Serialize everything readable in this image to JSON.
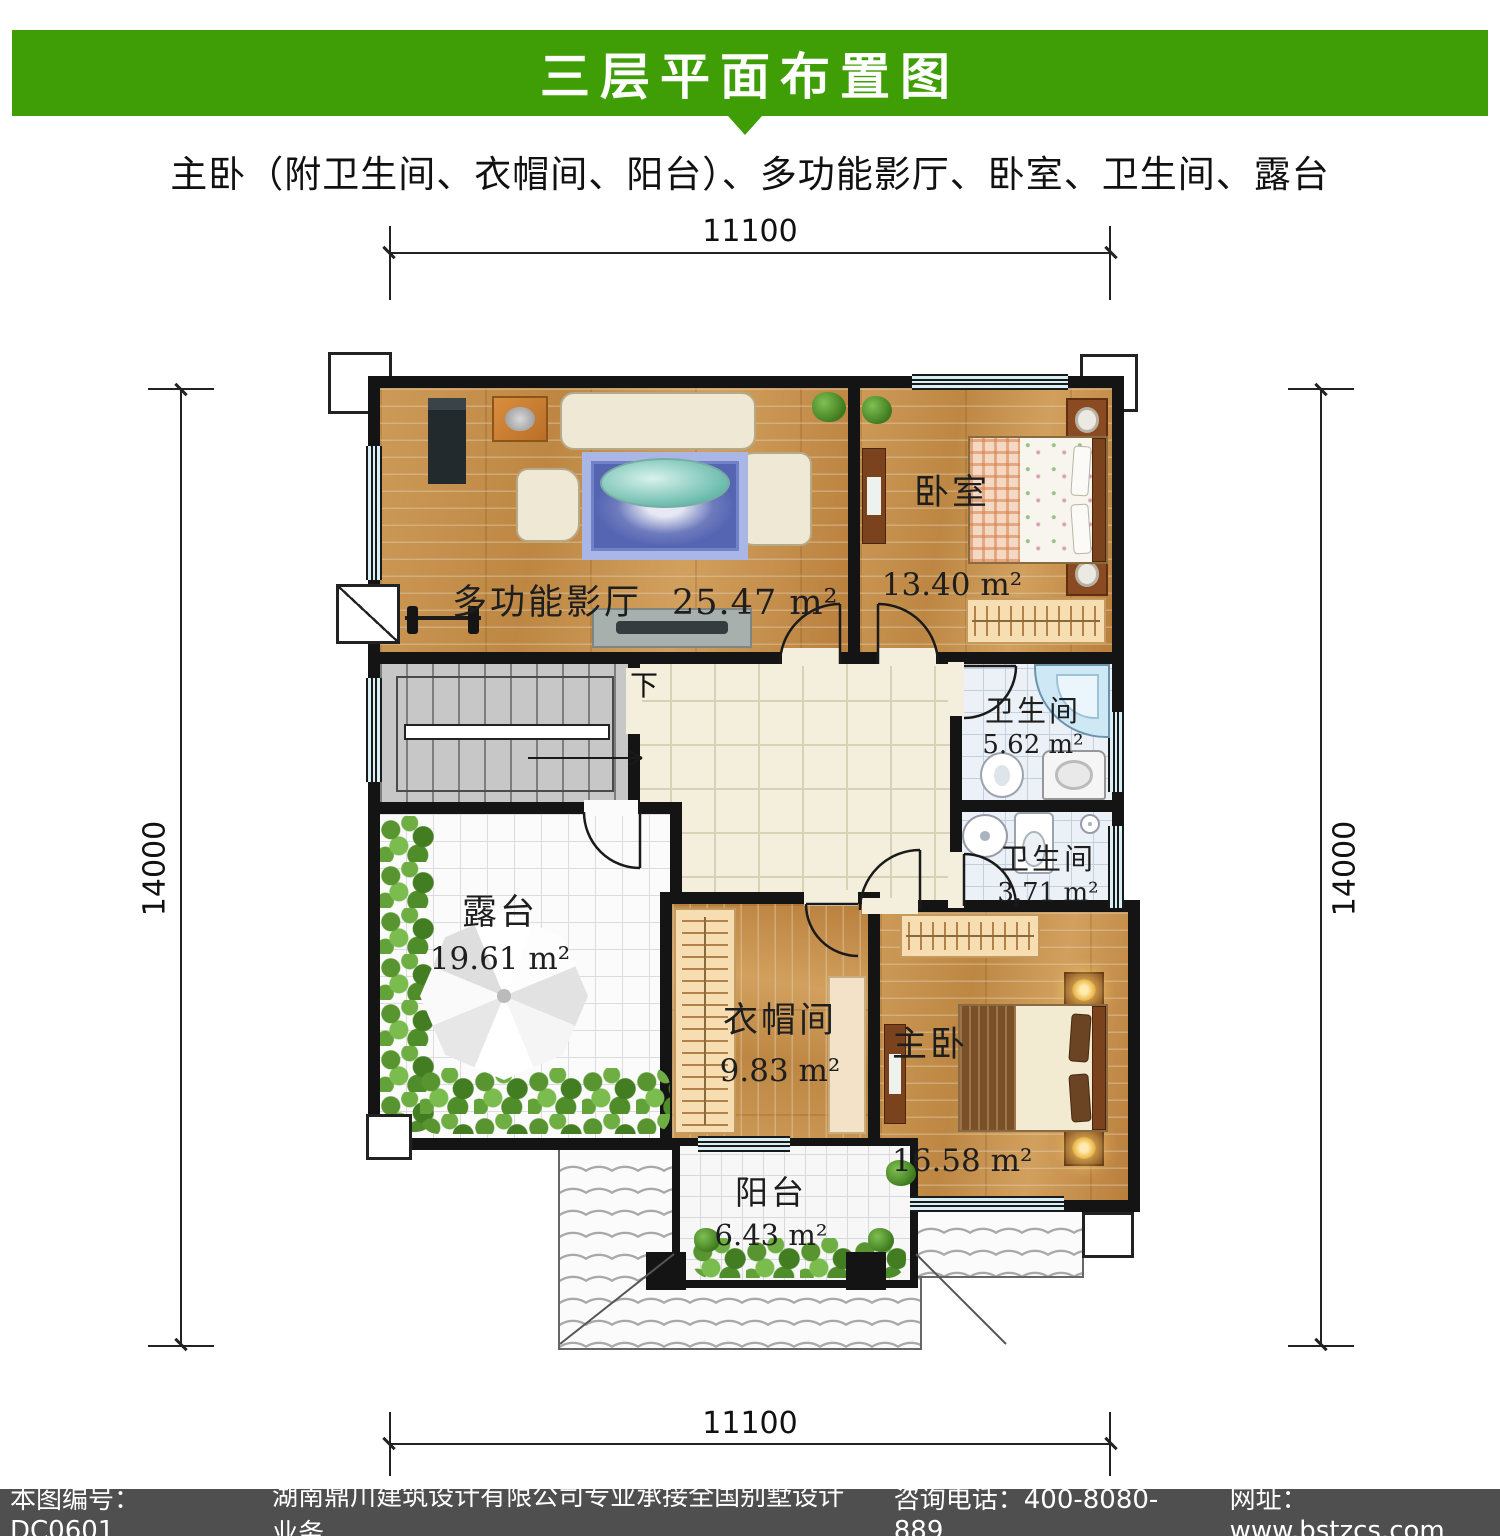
{
  "header": {
    "title": "三层平面布置图",
    "bg_color": "#3f9e06"
  },
  "subtitle": "主卧（附卫生间、衣帽间、阳台）、多功能影厅、卧室、卫生间、露台",
  "dimensions": {
    "top": "11100",
    "bottom": "11100",
    "left": "14000",
    "right": "14000"
  },
  "plan": {
    "stairs_down_label": "下"
  },
  "rooms": [
    {
      "id": "theater",
      "name": "多功能影厅",
      "area": "25.47 m²"
    },
    {
      "id": "bedroom",
      "name": "卧室",
      "area": "13.40 m²"
    },
    {
      "id": "bath1",
      "name": "卫生间",
      "area": "5.62 m²"
    },
    {
      "id": "bath2",
      "name": "卫生间",
      "area": "3.71 m²"
    },
    {
      "id": "terrace",
      "name": "露台",
      "area": "19.61 m²"
    },
    {
      "id": "closet",
      "name": "衣帽间",
      "area": "9.83 m²"
    },
    {
      "id": "master",
      "name": "主卧",
      "area": "16.58 m²"
    },
    {
      "id": "balcony",
      "name": "阳台",
      "area": "6.43 m²"
    }
  ],
  "watermark": {
    "logo_glyph": "川",
    "cn": "鼎川建筑",
    "en": "DINGCHUAN JIANZHU",
    "accent_color": "#2a78c0"
  },
  "footer": {
    "drawing_no": "本图编号：DC0601",
    "company": "湖南鼎川建筑设计有限公司专业承接全国别墅设计业务",
    "phone": "咨询电话：400-8080-889",
    "website": "网址：www.bstzcs.com",
    "bg_color": "#4f4f4f"
  }
}
